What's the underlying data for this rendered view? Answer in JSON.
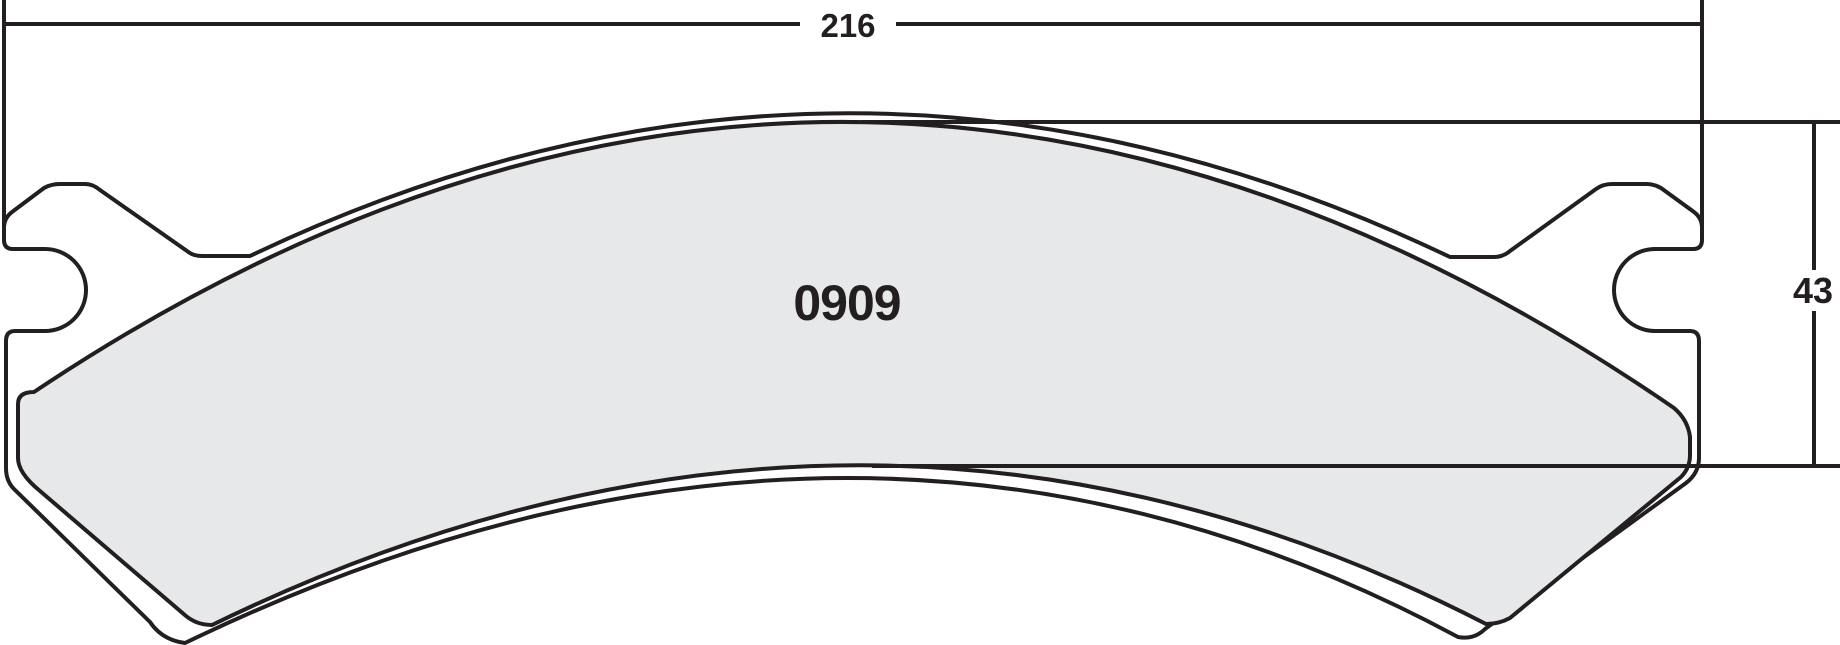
{
  "drawing": {
    "type": "brake-pad-technical-drawing",
    "part_number": "0909",
    "width_dimension": "216",
    "height_dimension": "43"
  },
  "colors": {
    "line": "#231f20",
    "friction_fill": "#e7e8ea",
    "backing_fill": "#ffffff",
    "background": "#ffffff"
  }
}
